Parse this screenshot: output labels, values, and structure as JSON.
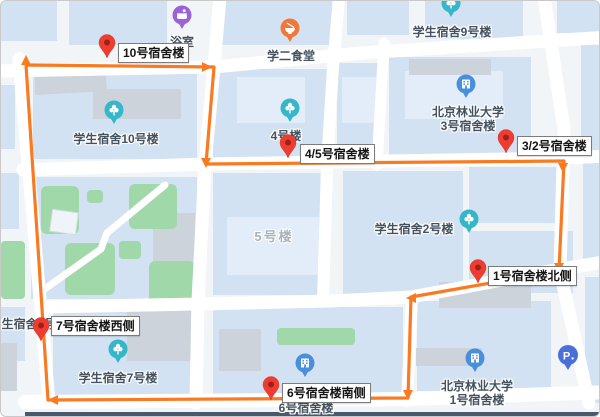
{
  "route": {
    "color": "#f97a20",
    "stop_pin_color": "#ee3d30",
    "shape": "closed-loop-clockwise",
    "stops": [
      {
        "label": "10号宿舍楼"
      },
      {
        "label": "4/5号宿舍楼"
      },
      {
        "label": "3/2号宿舍楼"
      },
      {
        "label": "1号宿舍楼北侧"
      },
      {
        "label": "7号宿舍楼西侧"
      },
      {
        "label": "6号宿舍楼南侧"
      }
    ]
  },
  "pois": [
    {
      "name": "浴室",
      "icon": "bath-icon",
      "pin_color": "#9a63d6"
    },
    {
      "name": "学二食堂",
      "icon": "food-icon",
      "pin_color": "#f0793a"
    },
    {
      "name": "学生宿舍9号楼",
      "icon": "plant-icon",
      "pin_color": "#35b6c9"
    },
    {
      "name": "北京林业大学",
      "name2": "3号宿舍楼",
      "icon": "building-icon",
      "pin_color": "#4a8fdb"
    },
    {
      "name": "学生宿舍10号楼",
      "icon": "plant-icon",
      "pin_color": "#35b6c9"
    },
    {
      "name": "4号楼",
      "icon": "plant-icon",
      "pin_color": "#35b6c9"
    },
    {
      "name": "5号楼",
      "icon": "none",
      "pin_color": ""
    },
    {
      "name": "学生宿舍2号楼",
      "icon": "plant-icon",
      "pin_color": "#35b6c9"
    },
    {
      "name": "学生宿舍8号楼",
      "icon": "none",
      "pin_color": ""
    },
    {
      "name": "学生宿舍7号楼",
      "icon": "plant-icon",
      "pin_color": "#35b6c9"
    },
    {
      "name": "6号宿舍楼",
      "icon": "building-icon",
      "pin_color": "#4a8fdb"
    },
    {
      "name": "北京林业大学",
      "name2": "1号宿舍楼",
      "icon": "building-icon",
      "pin_color": "#4a8fdb"
    },
    {
      "name": "P",
      "icon": "parking-icon",
      "pin_color": "#4a6fd8"
    }
  ],
  "map_colors": {
    "background": "#f2f5f8",
    "building_block": "#d2e2f2",
    "building_inner": "#e2edf9",
    "green_area": "#a0d8aa",
    "gray_building": "#ccd3da",
    "road": "#ffffff"
  }
}
